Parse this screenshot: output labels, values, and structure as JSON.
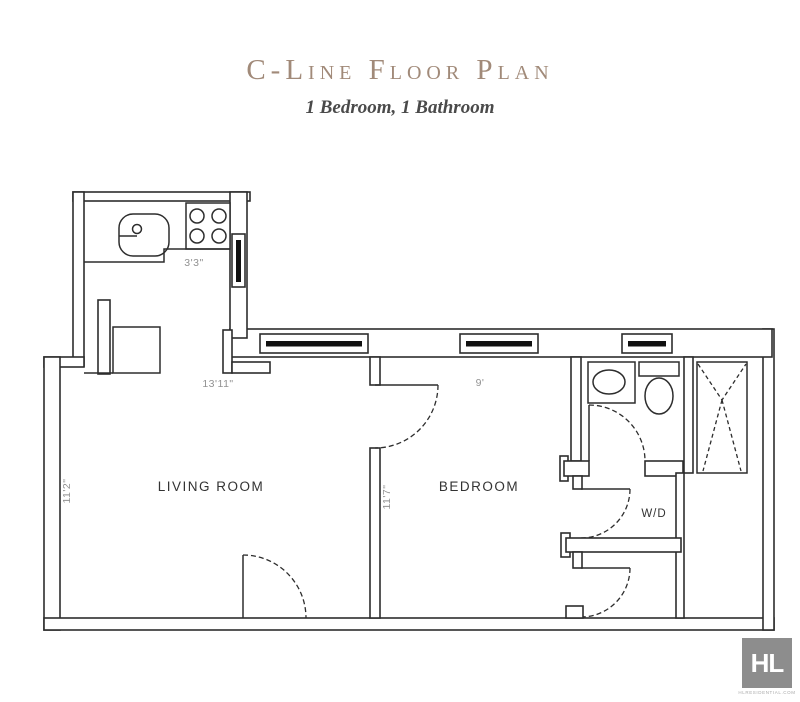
{
  "header": {
    "title": "C-Line Floor Plan",
    "subtitle": "1 Bedroom, 1 Bathroom"
  },
  "plan": {
    "rooms": {
      "living_room": "LIVING ROOM",
      "bedroom": "BEDROOM",
      "washer_dryer": "W/D"
    },
    "dimensions": {
      "kitchen_counter": "3'3\"",
      "living_room_width": "13'11\"",
      "living_room_depth": "11'2\"",
      "bedroom_width": "9'",
      "bedroom_depth": "11'7\""
    }
  },
  "logo": {
    "monogram": "HL",
    "caption": "HLRESIDENTIAL.COM"
  },
  "colors": {
    "title_text": "#a18a79",
    "subtitle_text": "#4a4a4a",
    "wall_line": "#2d2d2d",
    "dimension_text": "#929292",
    "room_label_text": "#333333",
    "window_glass": "#111111",
    "logo_background": "#8d8d8d",
    "logo_text": "#ffffff"
  }
}
